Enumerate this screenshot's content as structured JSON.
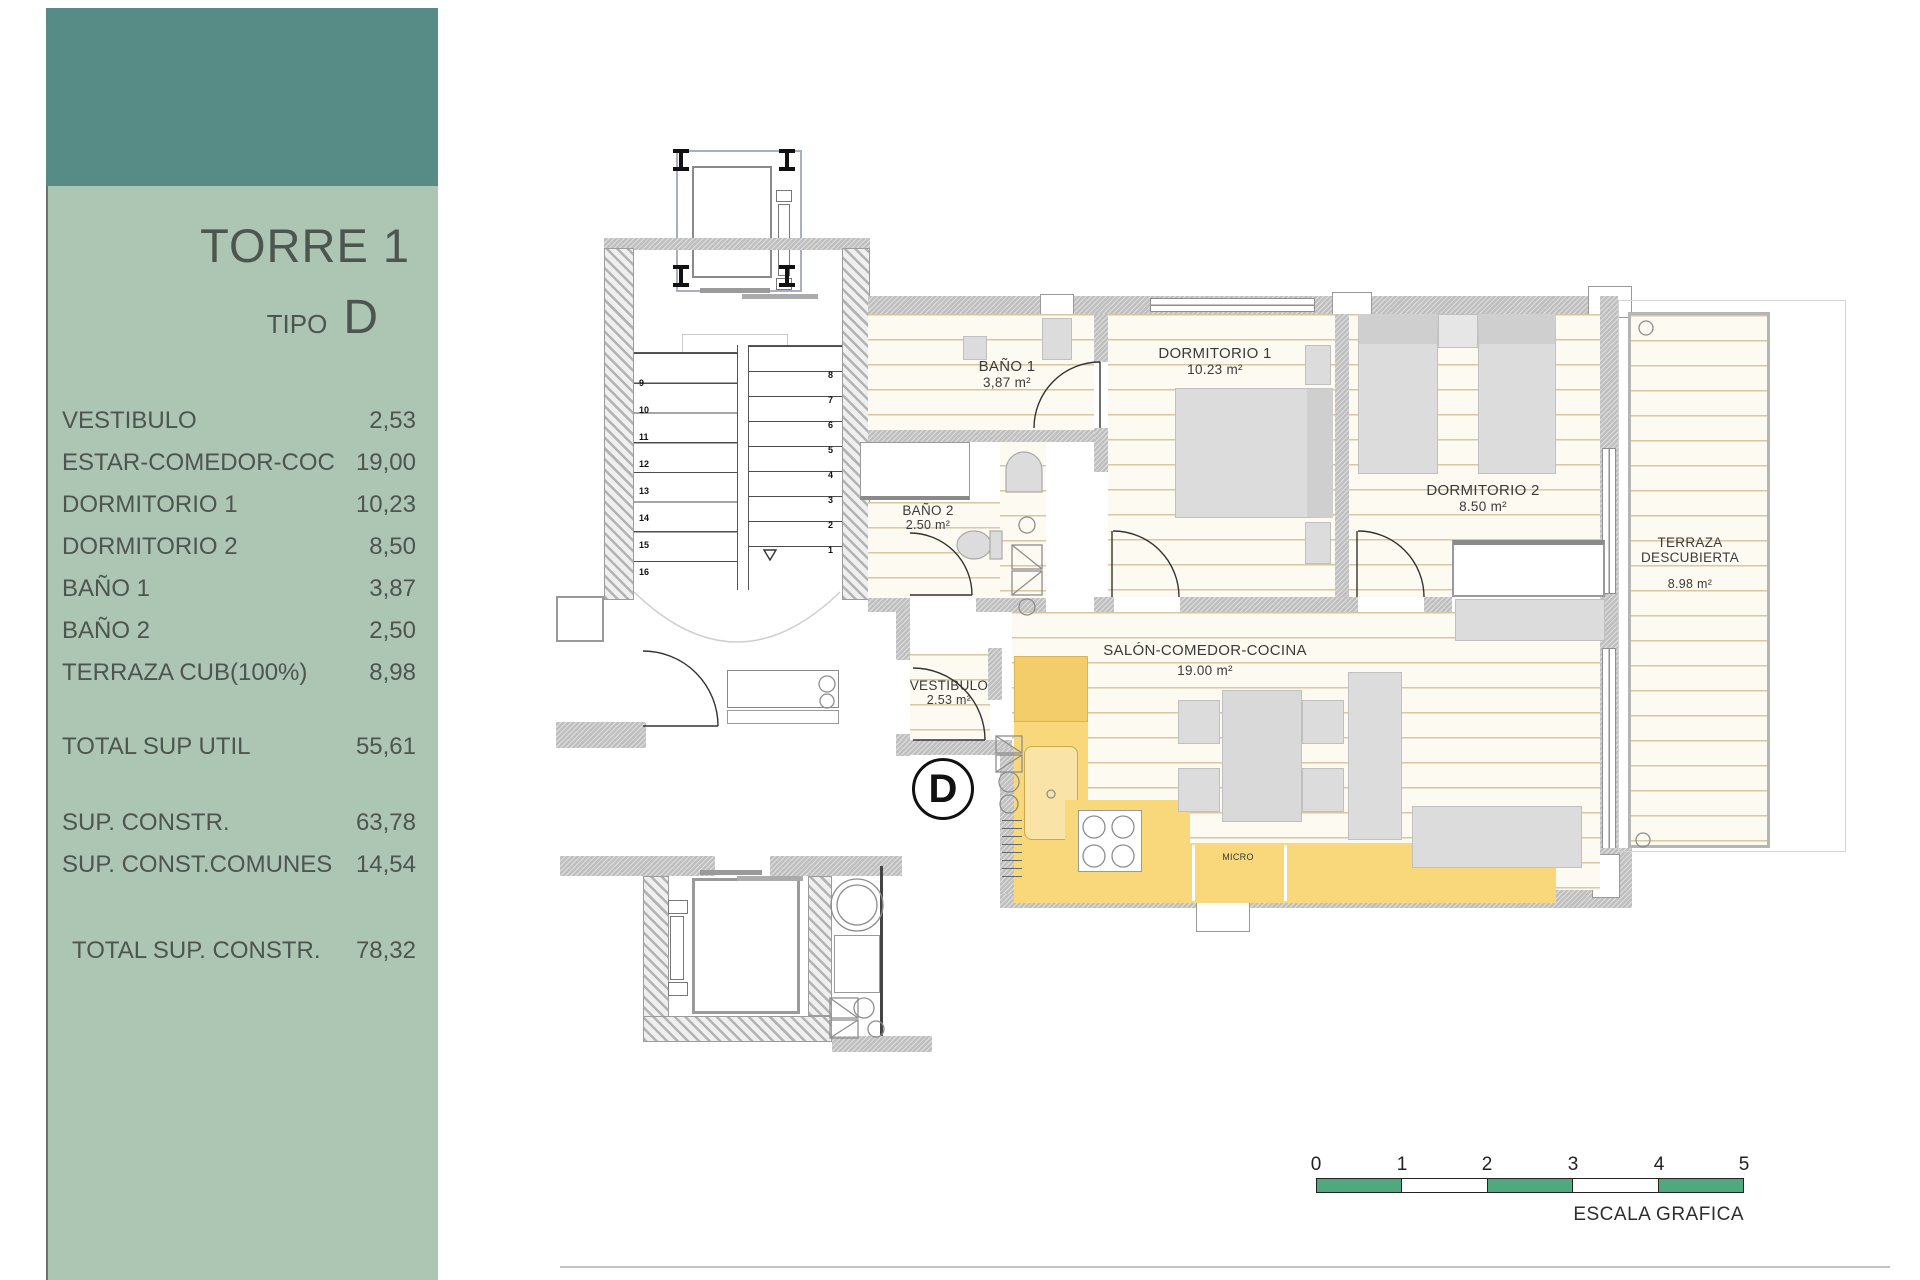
{
  "sidebar": {
    "title": "TORRE 1",
    "tipo_label": "TIPO",
    "tipo_value": "D",
    "colors": {
      "header": "#578b85",
      "panel": "#adc6b4",
      "text": "#4c554e"
    },
    "rooms": [
      {
        "label": "VESTIBULO",
        "value": "2,53"
      },
      {
        "label": "ESTAR-COMEDOR-COC",
        "value": "19,00"
      },
      {
        "label": "DORMITORIO 1",
        "value": "10,23"
      },
      {
        "label": "DORMITORIO 2",
        "value": "8,50"
      },
      {
        "label": "BAÑO 1",
        "value": "3,87"
      },
      {
        "label": "BAÑO 2",
        "value": "2,50"
      },
      {
        "label": "TERRAZA CUB(100%)",
        "value": "8,98"
      }
    ],
    "totals": [
      {
        "label": "TOTAL SUP UTIL",
        "value": "55,61"
      },
      {
        "label": "SUP. CONSTR.",
        "value": "63,78"
      },
      {
        "label": "SUP. CONST.COMUNES",
        "value": "14,54"
      },
      {
        "label": "TOTAL SUP. CONSTR.",
        "value": "78,32"
      }
    ]
  },
  "plan": {
    "unit_letter": "D",
    "labels": {
      "bano1": {
        "name": "BAÑO 1",
        "area": "3,87 m²"
      },
      "dormitorio1": {
        "name": "DORMITORIO 1",
        "area": "10.23 m²"
      },
      "dormitorio2": {
        "name": "DORMITORIO 2",
        "area": "8.50 m²"
      },
      "bano2": {
        "name": "BAÑO 2",
        "area": "2.50 m²"
      },
      "terraza": {
        "name_line1": "TERRAZA",
        "name_line2": "DESCUBIERTA",
        "area": "8.98 m²"
      },
      "salon": {
        "name": "SALÓN-COMEDOR-COCINA",
        "area": "19.00 m²"
      },
      "vestibulo": {
        "name": "VESTIBULO",
        "area": "2.53 m²"
      },
      "micro": "MICRO"
    },
    "stairs": {
      "left_numbers": [
        "9",
        "10",
        "11",
        "12",
        "13",
        "14",
        "15",
        "16"
      ],
      "right_numbers": [
        "8",
        "7",
        "6",
        "5",
        "4",
        "3",
        "2",
        "1"
      ]
    }
  },
  "scale_bar": {
    "ticks": [
      "0",
      "1",
      "2",
      "3",
      "4",
      "5"
    ],
    "caption": "ESCALA GRAFICA",
    "green": "#4fa87e"
  }
}
